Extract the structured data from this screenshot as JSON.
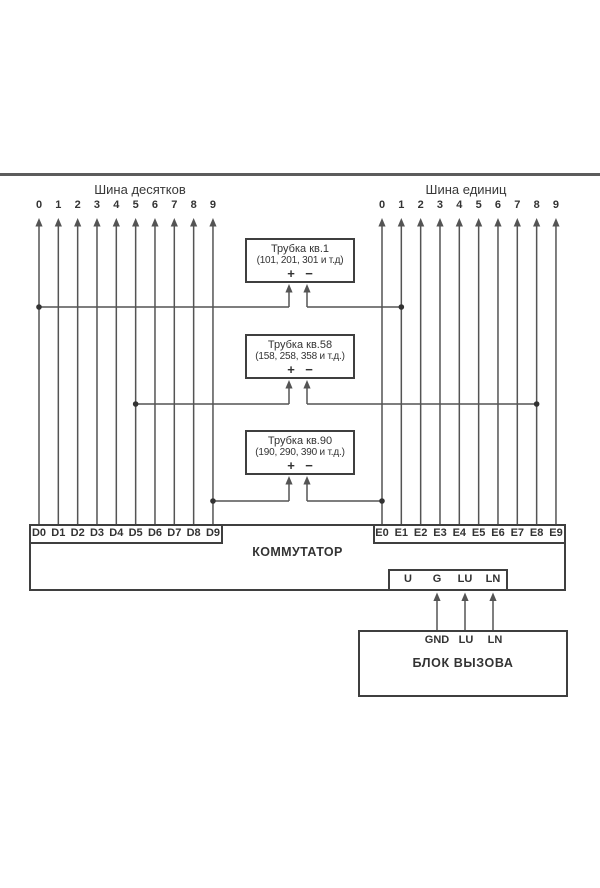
{
  "buses": {
    "tens": {
      "title": "Шина десятков",
      "digits": [
        "0",
        "1",
        "2",
        "3",
        "4",
        "5",
        "6",
        "7",
        "8",
        "9"
      ]
    },
    "units": {
      "title": "Шина единиц",
      "digits": [
        "0",
        "1",
        "2",
        "3",
        "4",
        "5",
        "6",
        "7",
        "8",
        "9"
      ]
    }
  },
  "handsets": [
    {
      "title": "Трубка  кв.1",
      "subtitle": "(101, 201, 301 и т.д)",
      "plus": "+",
      "minus": "−",
      "tens_line": 0,
      "units_line": 1
    },
    {
      "title": "Трубка кв.58",
      "subtitle": "(158, 258, 358 и т.д.)",
      "plus": "+",
      "minus": "−",
      "tens_line": 5,
      "units_line": 8
    },
    {
      "title": "Трубка кв.90",
      "subtitle": "(190, 290, 390 и т.д.)",
      "plus": "+",
      "minus": "−",
      "tens_line": 9,
      "units_line": 0
    }
  ],
  "commutator": {
    "label": "КОММУТАТОР",
    "d_terminals": [
      "D0",
      "D1",
      "D2",
      "D3",
      "D4",
      "D5",
      "D6",
      "D7",
      "D8",
      "D9"
    ],
    "e_terminals": [
      "E0",
      "E1",
      "E2",
      "E3",
      "E4",
      "E5",
      "E6",
      "E7",
      "E8",
      "E9"
    ],
    "aux_terminals": [
      "U",
      "G",
      "LU",
      "LN"
    ]
  },
  "call_block": {
    "label": "БЛОК ВЫЗОВА",
    "terminals": [
      "GND",
      "LU",
      "LN"
    ]
  },
  "colors": {
    "line": "#545454",
    "border": "#3f3f3f",
    "text": "#333333",
    "rule": "#5c5c5c"
  }
}
